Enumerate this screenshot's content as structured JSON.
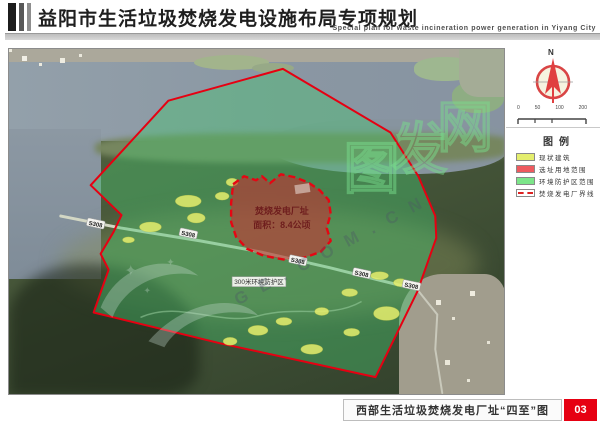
{
  "header": {
    "title_cn": "益阳市生活垃圾焚烧发电设施布局专项规划",
    "title_en": "Special plan for waste incineration power generation in Yiyang City"
  },
  "compass": {
    "north": "N"
  },
  "scalebar": {
    "ticks": [
      "0",
      "50",
      "100",
      "200"
    ]
  },
  "legend": {
    "title": "图例",
    "items": [
      {
        "label": "现状建筑",
        "color": "#e4ee6e",
        "type": "fill"
      },
      {
        "label": "选址用地范围",
        "color": "#ee5a5f",
        "type": "fill"
      },
      {
        "label": "环境防护区范围",
        "color": "#7ce589",
        "type": "fill"
      },
      {
        "label": "焚烧发电厂界线",
        "color": "#dd2222",
        "type": "dashed-line"
      }
    ]
  },
  "map": {
    "road_label": "S308",
    "buffer_label": "300米环境防护区",
    "site_label_line1": "焚烧发电厂址",
    "site_label_line2": "面积：8.4公顷",
    "watermark_cn_chars": [
      "图",
      "发",
      "网"
    ],
    "watermark_latin": "GE.COM.CN",
    "colors": {
      "boundary_red": "#e60012",
      "site_fill_red": "#d7404a",
      "protection_green": "#52c878",
      "building_yellow": "#e6ef6d"
    }
  },
  "footer": {
    "caption": "西部生活垃圾焚烧发电厂址“四至”图",
    "page": "03"
  }
}
